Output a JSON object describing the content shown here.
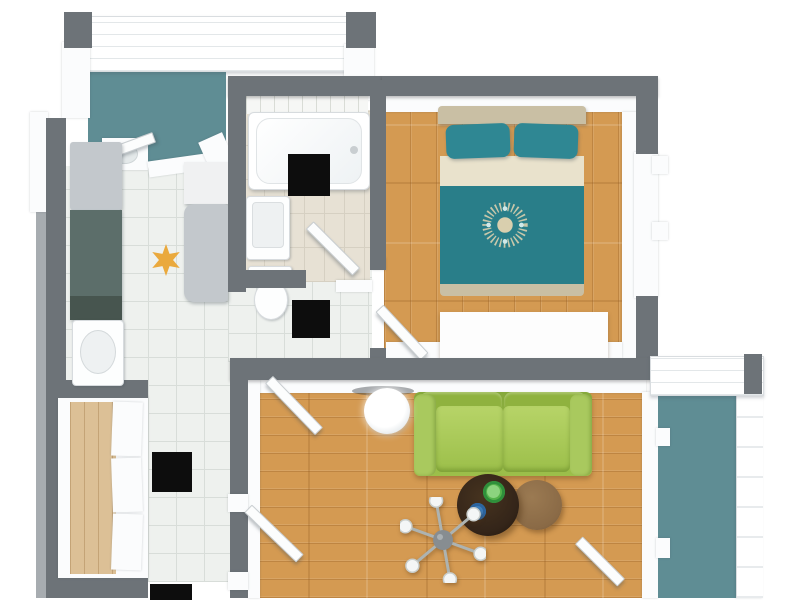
{
  "document": {
    "title": "3D top-down floor plan of a one-bedroom apartment with two balconies"
  },
  "palette": {
    "wall_dark": "#6d7378",
    "wall_light_edge": "#a7acb0",
    "balcony_floor": "#5f8d94",
    "tile_floor": "#eef1ee",
    "tile_grout": "#d8ddd9",
    "bath_tile": "#e7e1d4",
    "bath_grout": "#d6d0c2",
    "wood_floor": "#d49a52",
    "closet_wood": "#dcc096",
    "bed_teal": "#297e89",
    "pillow_teal": "#2f8793",
    "linen_cream": "#e9e2cc",
    "headboard_tan": "#c9bfa4",
    "mandala_cream": "#d9cfae",
    "sofa_green": "#9cbf4a",
    "sofa_green_dark": "#86a93c",
    "coffee_table_brown": "#342519",
    "side_table_brown": "#8a6a46",
    "bowl_green": "#54b24a",
    "bowl_blue": "#3d80c0",
    "counter_teal_gray": "#5c6e6a",
    "appliance_gray": "#c3c8cc",
    "lamp_gray": "#878d91",
    "marker_black": "#0d0d0d",
    "star_orange": "#eaa93d"
  },
  "rooms": [
    {
      "name": "Balcony (top)",
      "floor": "teal",
      "position": "top-left"
    },
    {
      "name": "Kitchen",
      "floor": "white tile",
      "position": "left"
    },
    {
      "name": "Bathroom",
      "floor": "beige tile",
      "position": "top-center"
    },
    {
      "name": "Bedroom",
      "floor": "wood planks",
      "position": "top-right"
    },
    {
      "name": "Hallway",
      "floor": "white tile",
      "position": "center-left"
    },
    {
      "name": "Closet",
      "floor": "light wood",
      "position": "bottom-left"
    },
    {
      "name": "Living Room",
      "floor": "wood planks",
      "position": "bottom-center"
    },
    {
      "name": "Balcony (right)",
      "floor": "teal",
      "position": "bottom-right"
    }
  ],
  "furniture": {
    "kitchen": [
      "refrigerator",
      "dark counter run",
      "sink unit",
      "appliance cabinet"
    ],
    "bathroom": [
      "bathtub",
      "wash basin",
      "toilet"
    ],
    "bedroom": [
      "double bed with teal cover, two teal pillows and mandala throw",
      "white rug at foot of bed"
    ],
    "living_room": [
      "green two-seat sofa",
      "dark round coffee table",
      "green bowl",
      "blue bowl",
      "round wooden side table",
      "six-arm floor lamp",
      "round white side table"
    ],
    "closet": [
      "open wardrobe with white door panels"
    ]
  },
  "markers": {
    "black_squares": {
      "count": 4,
      "locations": [
        "on bathtub edge",
        "hallway below bathroom",
        "hallway middle",
        "hallway bottom edge (cut off)"
      ]
    },
    "orange_star": {
      "count": 1,
      "location": "kitchen floor"
    }
  },
  "doors_windows": {
    "open_door_leaves": 6,
    "balconies": 2,
    "windows": [
      "kitchen to top balcony",
      "kitchen west wall",
      "bedroom east wall",
      "living room to right balcony"
    ]
  }
}
